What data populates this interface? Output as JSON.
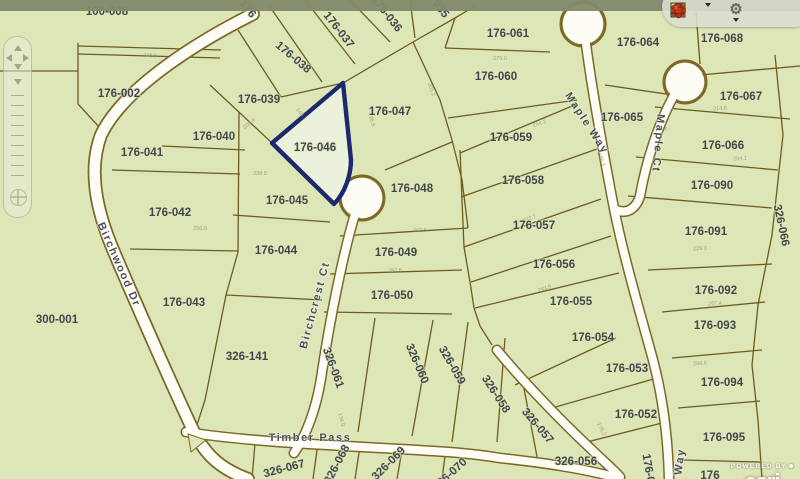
{
  "watermark": {
    "powered_by": "POWERED BY",
    "brand": "esri"
  },
  "colors": {
    "map_background": "#dde6b6",
    "parcel_line": "#6f5b1e",
    "road_fill": "#fdfdf6",
    "road_casing": "#7d6729",
    "highlight_stroke": "#1c2a6d",
    "highlight_fill": "#ecf1dd",
    "label_text": "#40464a",
    "top_strip": "#7f8a6c"
  },
  "toolbar": {
    "icons": [
      {
        "name": "layers-grid",
        "has_dropdown": true
      },
      {
        "name": "binoculars-find",
        "has_dropdown": true
      },
      {
        "name": "gear-tools",
        "has_dropdown": true,
        "glyph": "⚙"
      },
      {
        "name": "globe-red",
        "has_dropdown": false
      }
    ]
  },
  "nav_widget": {
    "controls": [
      "pan-north",
      "pan-west",
      "pan-east",
      "pan-south",
      "zoom-slider",
      "world-view"
    ]
  },
  "highlight": {
    "parcel": "176-046"
  },
  "parcels": [
    {
      "label": "100-008"
    },
    {
      "label": "176-002"
    },
    {
      "label": "176-039"
    },
    {
      "label": "176-040"
    },
    {
      "label": "176-041"
    },
    {
      "label": "176-042"
    },
    {
      "label": "176-043"
    },
    {
      "label": "300-001"
    },
    {
      "label": "326-141"
    },
    {
      "label": "176-045"
    },
    {
      "label": "176-044"
    },
    {
      "label": "176-046"
    },
    {
      "label": "176-047"
    },
    {
      "label": "176-048"
    },
    {
      "label": "176-049"
    },
    {
      "label": "176-050"
    },
    {
      "label": "176-038"
    },
    {
      "label": "176-037"
    },
    {
      "label": "176-036"
    },
    {
      "label": "176-061"
    },
    {
      "label": "176-060"
    },
    {
      "label": "176-059"
    },
    {
      "label": "176-058"
    },
    {
      "label": "176-057"
    },
    {
      "label": "176-056"
    },
    {
      "label": "176-055"
    },
    {
      "label": "176-054"
    },
    {
      "label": "176-053"
    },
    {
      "label": "176-052"
    },
    {
      "label": "176-064"
    },
    {
      "label": "176-065"
    },
    {
      "label": "176-068"
    },
    {
      "label": "176-067"
    },
    {
      "label": "176-066"
    },
    {
      "label": "176-090"
    },
    {
      "label": "176-091"
    },
    {
      "label": "176-092"
    },
    {
      "label": "176-093"
    },
    {
      "label": "176-094"
    },
    {
      "label": "176-095"
    },
    {
      "label": "326-066"
    },
    {
      "label": "326-061"
    },
    {
      "label": "326-060"
    },
    {
      "label": "326-059"
    },
    {
      "label": "326-058"
    },
    {
      "label": "326-057"
    },
    {
      "label": "326-056"
    },
    {
      "label": "326-067"
    },
    {
      "label": "326-068"
    },
    {
      "label": "326-069"
    }
  ],
  "partial_labels": [
    {
      "label": "176"
    },
    {
      "label": "035"
    },
    {
      "label": "326-070"
    },
    {
      "label": "176-0"
    },
    {
      "label": "176"
    }
  ],
  "streets": [
    {
      "name": "Birchwood  Dr"
    },
    {
      "name": "Birchcrest Ct"
    },
    {
      "name": "Maple Way"
    },
    {
      "name": "Maple Ct"
    },
    {
      "name": "Timber  Pass"
    },
    {
      "name": "Way"
    }
  ],
  "dimension_marks": [
    {
      "t": "248.6"
    },
    {
      "t": "208.4"
    },
    {
      "t": "249.1"
    },
    {
      "t": "195.5"
    },
    {
      "t": "301.2"
    },
    {
      "t": "275.0"
    },
    {
      "t": "244.2"
    },
    {
      "t": "186.3"
    },
    {
      "t": "296.4"
    },
    {
      "t": "214.8"
    },
    {
      "t": "254.1"
    },
    {
      "t": "229.3"
    },
    {
      "t": "267.4"
    },
    {
      "t": "288.6"
    },
    {
      "t": "312.7"
    },
    {
      "t": "243.8"
    },
    {
      "t": "302.5"
    },
    {
      "t": "297.6"
    },
    {
      "t": "238.5"
    },
    {
      "t": "256.8"
    },
    {
      "t": "134.0"
    },
    {
      "t": "176.2"
    }
  ]
}
